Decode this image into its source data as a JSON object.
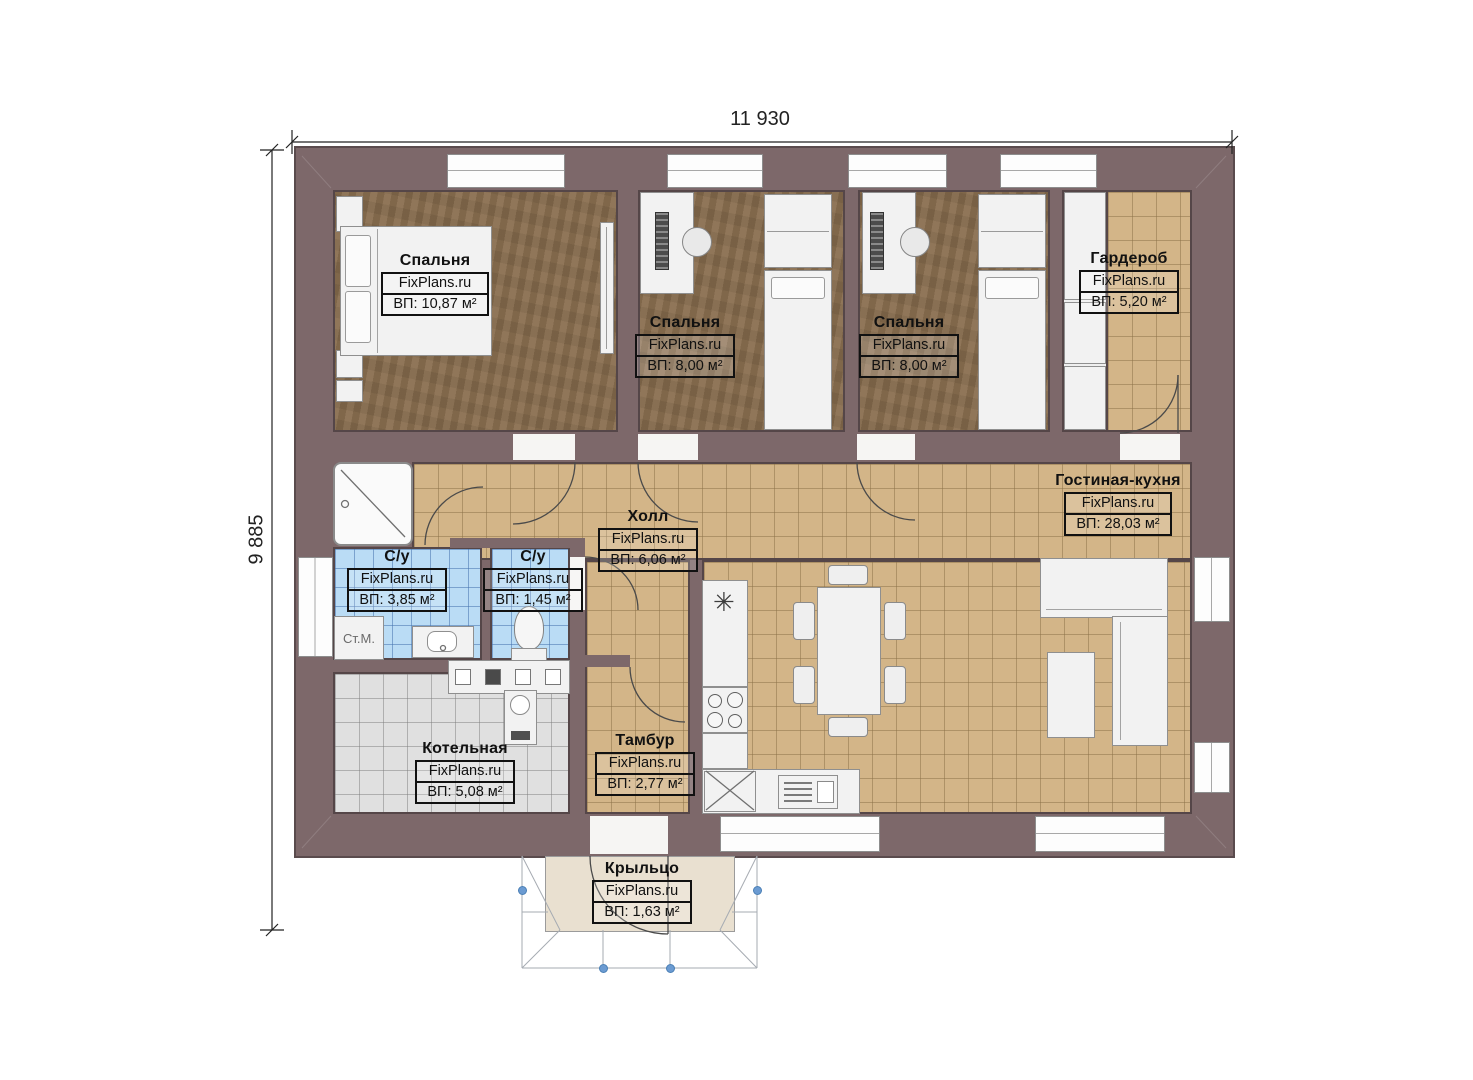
{
  "dimensions": {
    "width_label": "11 930",
    "height_label": "9 885"
  },
  "brand": "FixPlans.ru",
  "rooms": [
    {
      "id": "bedroom-1",
      "name": "Спальня",
      "brand": "FixPlans.ru",
      "area": "ВП: 10,87 м²"
    },
    {
      "id": "bedroom-2",
      "name": "Спальня",
      "brand": "FixPlans.ru",
      "area": "ВП: 8,00 м²"
    },
    {
      "id": "bedroom-3",
      "name": "Спальня",
      "brand": "FixPlans.ru",
      "area": "ВП: 8,00 м²"
    },
    {
      "id": "wardrobe",
      "name": "Гардероб",
      "brand": "FixPlans.ru",
      "area": "ВП: 5,20 м²"
    },
    {
      "id": "hall",
      "name": "Холл",
      "brand": "FixPlans.ru",
      "area": "ВП: 6,06 м²"
    },
    {
      "id": "living-kitchen",
      "name": "Гостиная-кухня",
      "brand": "FixPlans.ru",
      "area": "ВП: 28,03 м²"
    },
    {
      "id": "bathroom-1",
      "name": "С/у",
      "brand": "FixPlans.ru",
      "area": "ВП: 3,85 м²"
    },
    {
      "id": "bathroom-2",
      "name": "С/у",
      "brand": "FixPlans.ru",
      "area": "ВП: 1,45 м²"
    },
    {
      "id": "boiler-room",
      "name": "Котельная",
      "brand": "FixPlans.ru",
      "area": "ВП: 5,08 м²"
    },
    {
      "id": "vestibule",
      "name": "Тамбур",
      "brand": "FixPlans.ru",
      "area": "ВП: 2,77 м²"
    },
    {
      "id": "porch",
      "name": "Крыльцо",
      "brand": "FixPlans.ru",
      "area": "ВП: 1,63 м²"
    }
  ],
  "fixtures": {
    "washing_machine_label": "Ст.М.",
    "sink_symbol": "✳"
  },
  "colors": {
    "wall": "#7d686a",
    "wood_floor": "#8a6f50",
    "tile_floor": "#d3b588",
    "bath_tile": "#badcf5",
    "boiler_tile": "#e0e0e0",
    "porch_floor": "#e9e0d0",
    "furniture": "#f2f2f2",
    "handle_dot": "#6b9bd2"
  }
}
